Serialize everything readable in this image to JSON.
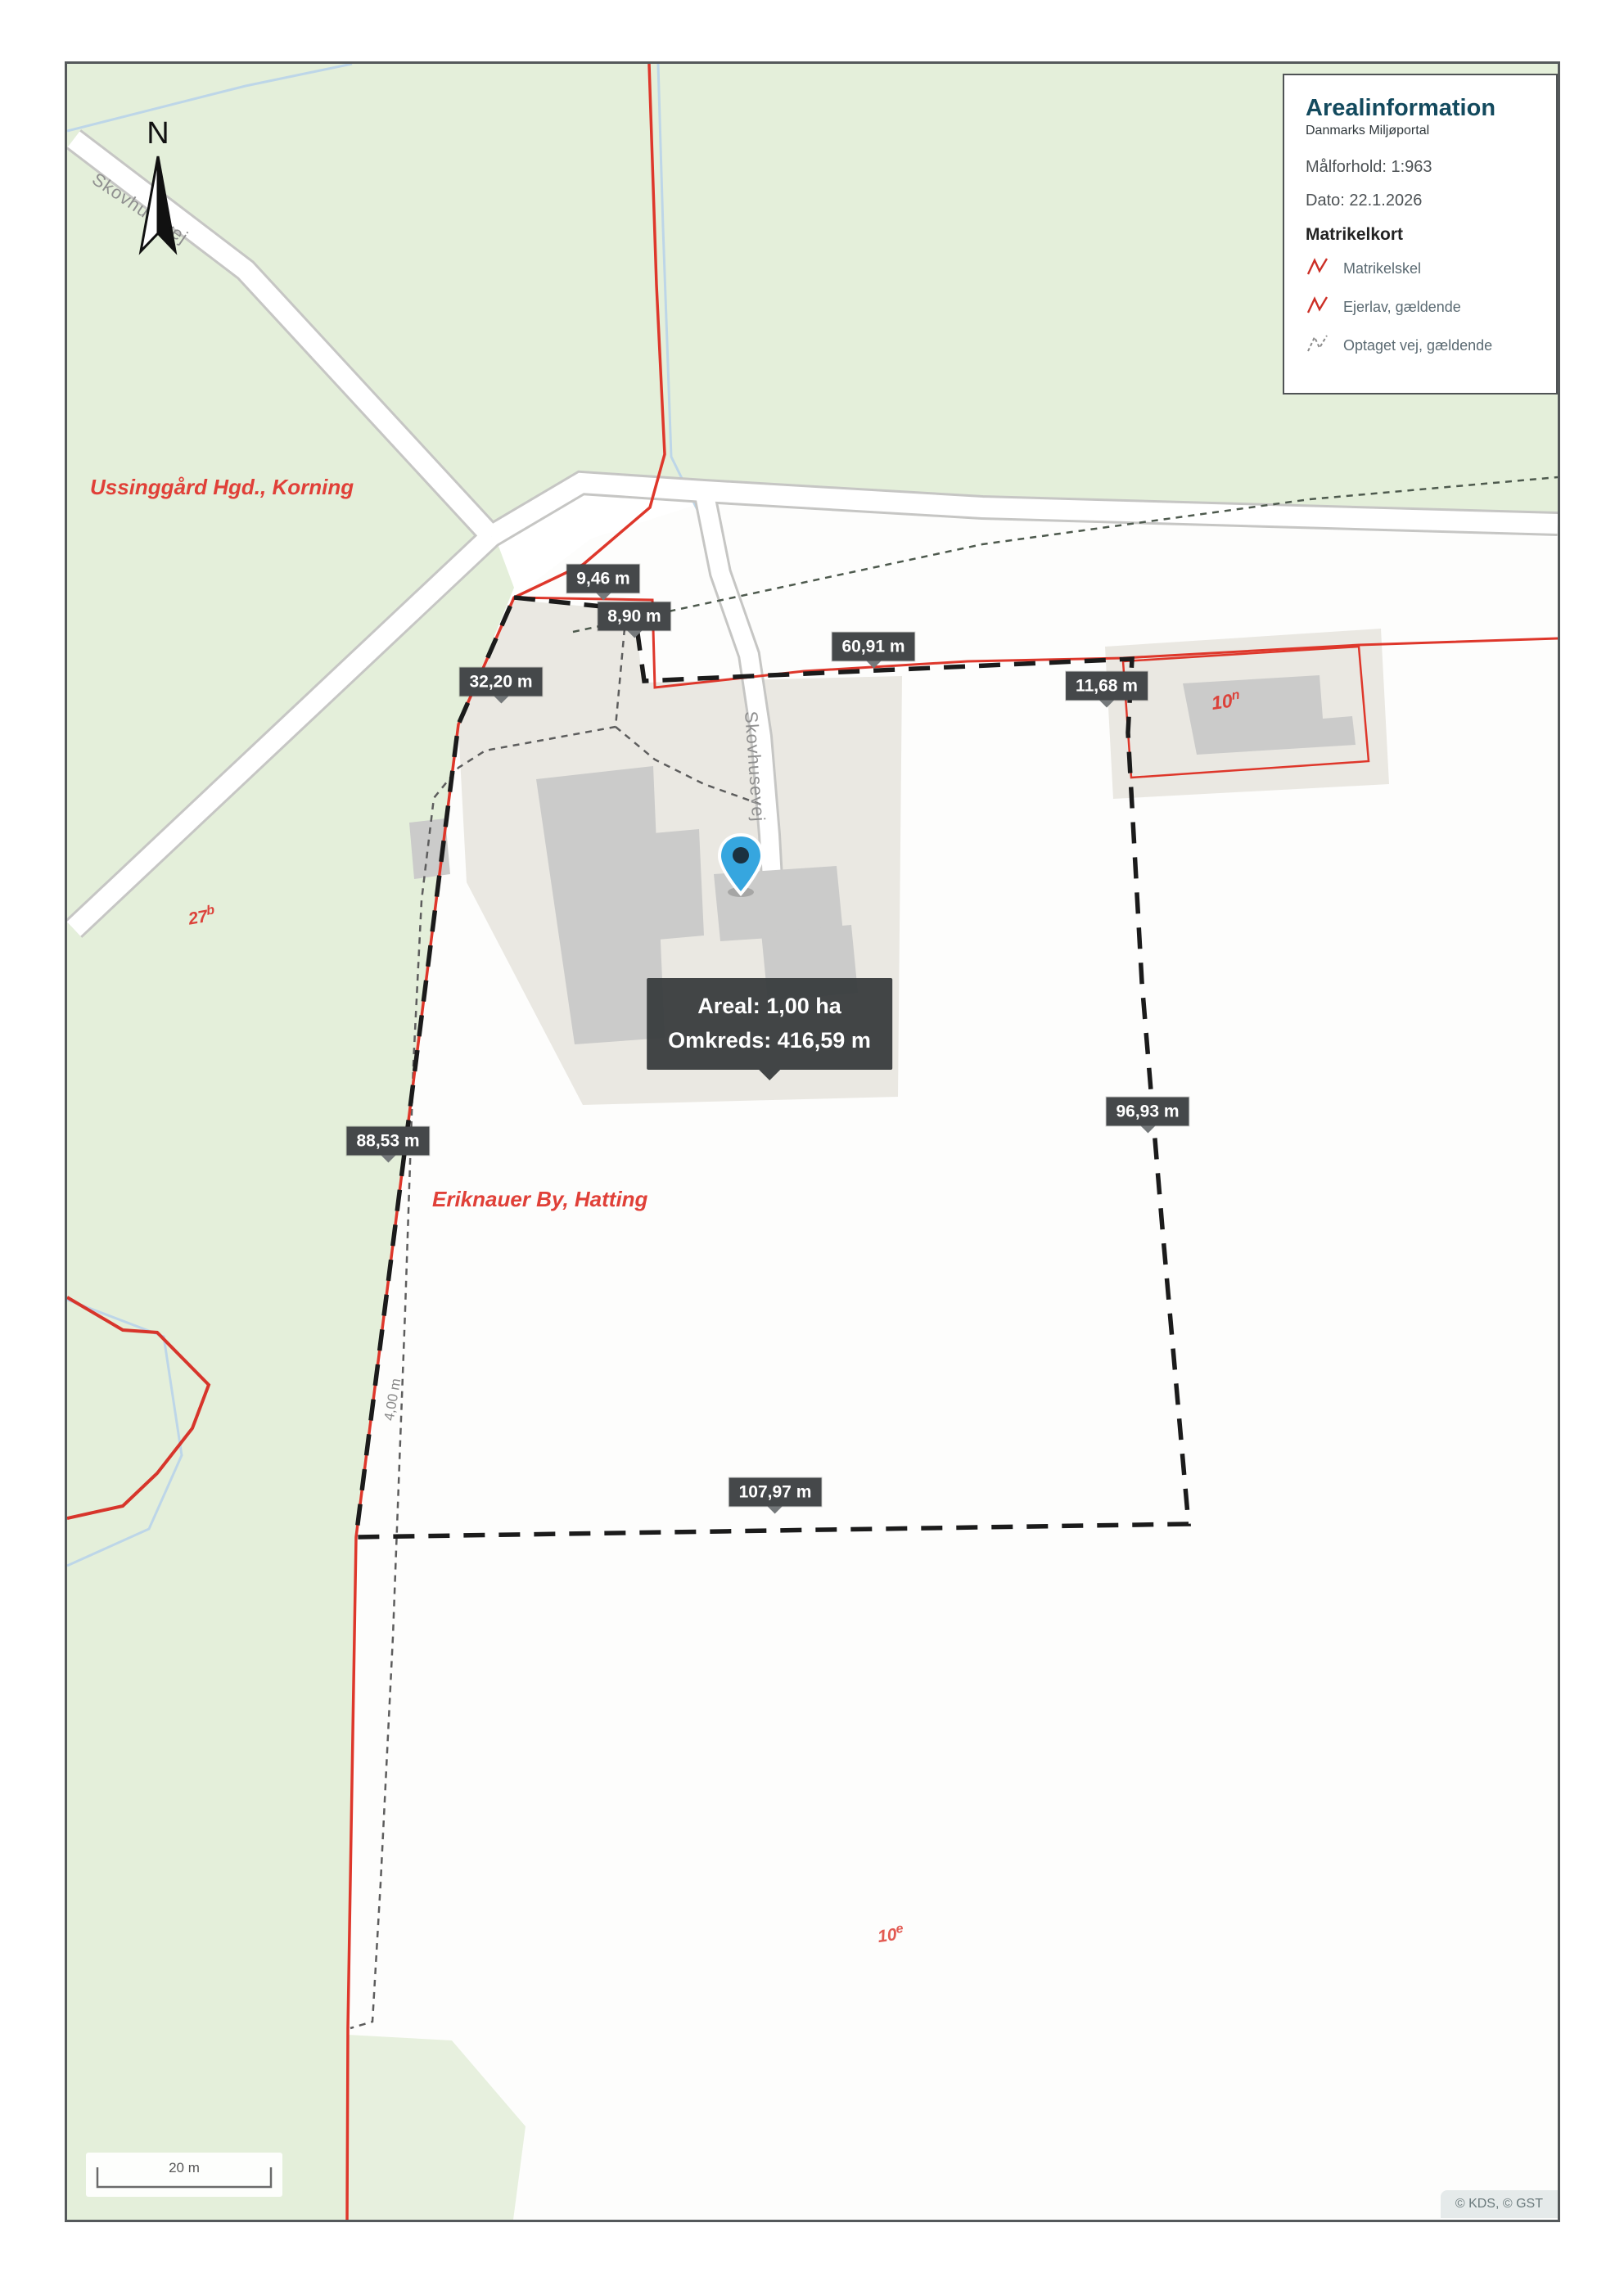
{
  "legend": {
    "title": "Arealinformation",
    "subtitle": "Danmarks Miljøportal",
    "scale_text": "Målforhold: 1:963",
    "date_text": "Dato: 22.1.2026",
    "section_title": "Matrikelkort",
    "items": [
      {
        "label": "Matrikelskel",
        "icon": "zigzag-red-solid"
      },
      {
        "label": "Ejerlav, gældende",
        "icon": "zigzag-red-solid"
      },
      {
        "label": "Optaget vej, gældende",
        "icon": "zigzag-gray-dashed"
      }
    ]
  },
  "map": {
    "north_label": "N",
    "street_labels": [
      {
        "text": "Skovhusevej"
      },
      {
        "text": "Skovhusevej"
      }
    ],
    "ejerlav_labels": [
      {
        "text": "Ussinggård Hgd., Korning"
      },
      {
        "text": "Eriknauer By, Hatting"
      }
    ],
    "parcels": [
      {
        "base": "27",
        "sup": "b"
      },
      {
        "base": "10",
        "sup": "n"
      },
      {
        "base": "10",
        "sup": "e"
      }
    ],
    "measurements": [
      {
        "label": "9,46 m"
      },
      {
        "label": "8,90 m"
      },
      {
        "label": "60,91 m"
      },
      {
        "label": "32,20 m"
      },
      {
        "label": "11,68 m"
      },
      {
        "label": "88,53 m"
      },
      {
        "label": "96,93 m"
      },
      {
        "label": "107,97 m"
      }
    ],
    "strip_width_label": "4,00 m",
    "tooltip": {
      "line1": "Areal: 1,00 ha",
      "line2": "Omkreds: 416,59 m"
    },
    "scalebar_label": "20 m",
    "attribution": "© KDS, © GST"
  },
  "colors": {
    "land_green": "#e4efda",
    "parcel_white": "#fdfdfc",
    "parcel_beige": "#eae8e2",
    "building_gray": "#cbcbca",
    "road_fill": "#ffffff",
    "road_casing": "#c6c6c4",
    "boundary_red": "#de372b",
    "measure_dash_black": "#1b1b1b",
    "cadastral_dash_gray": "#5d5d5d",
    "stream_blue": "#bdd6e8",
    "badge_bg": "#45484a",
    "title_teal": "#134a5e"
  }
}
